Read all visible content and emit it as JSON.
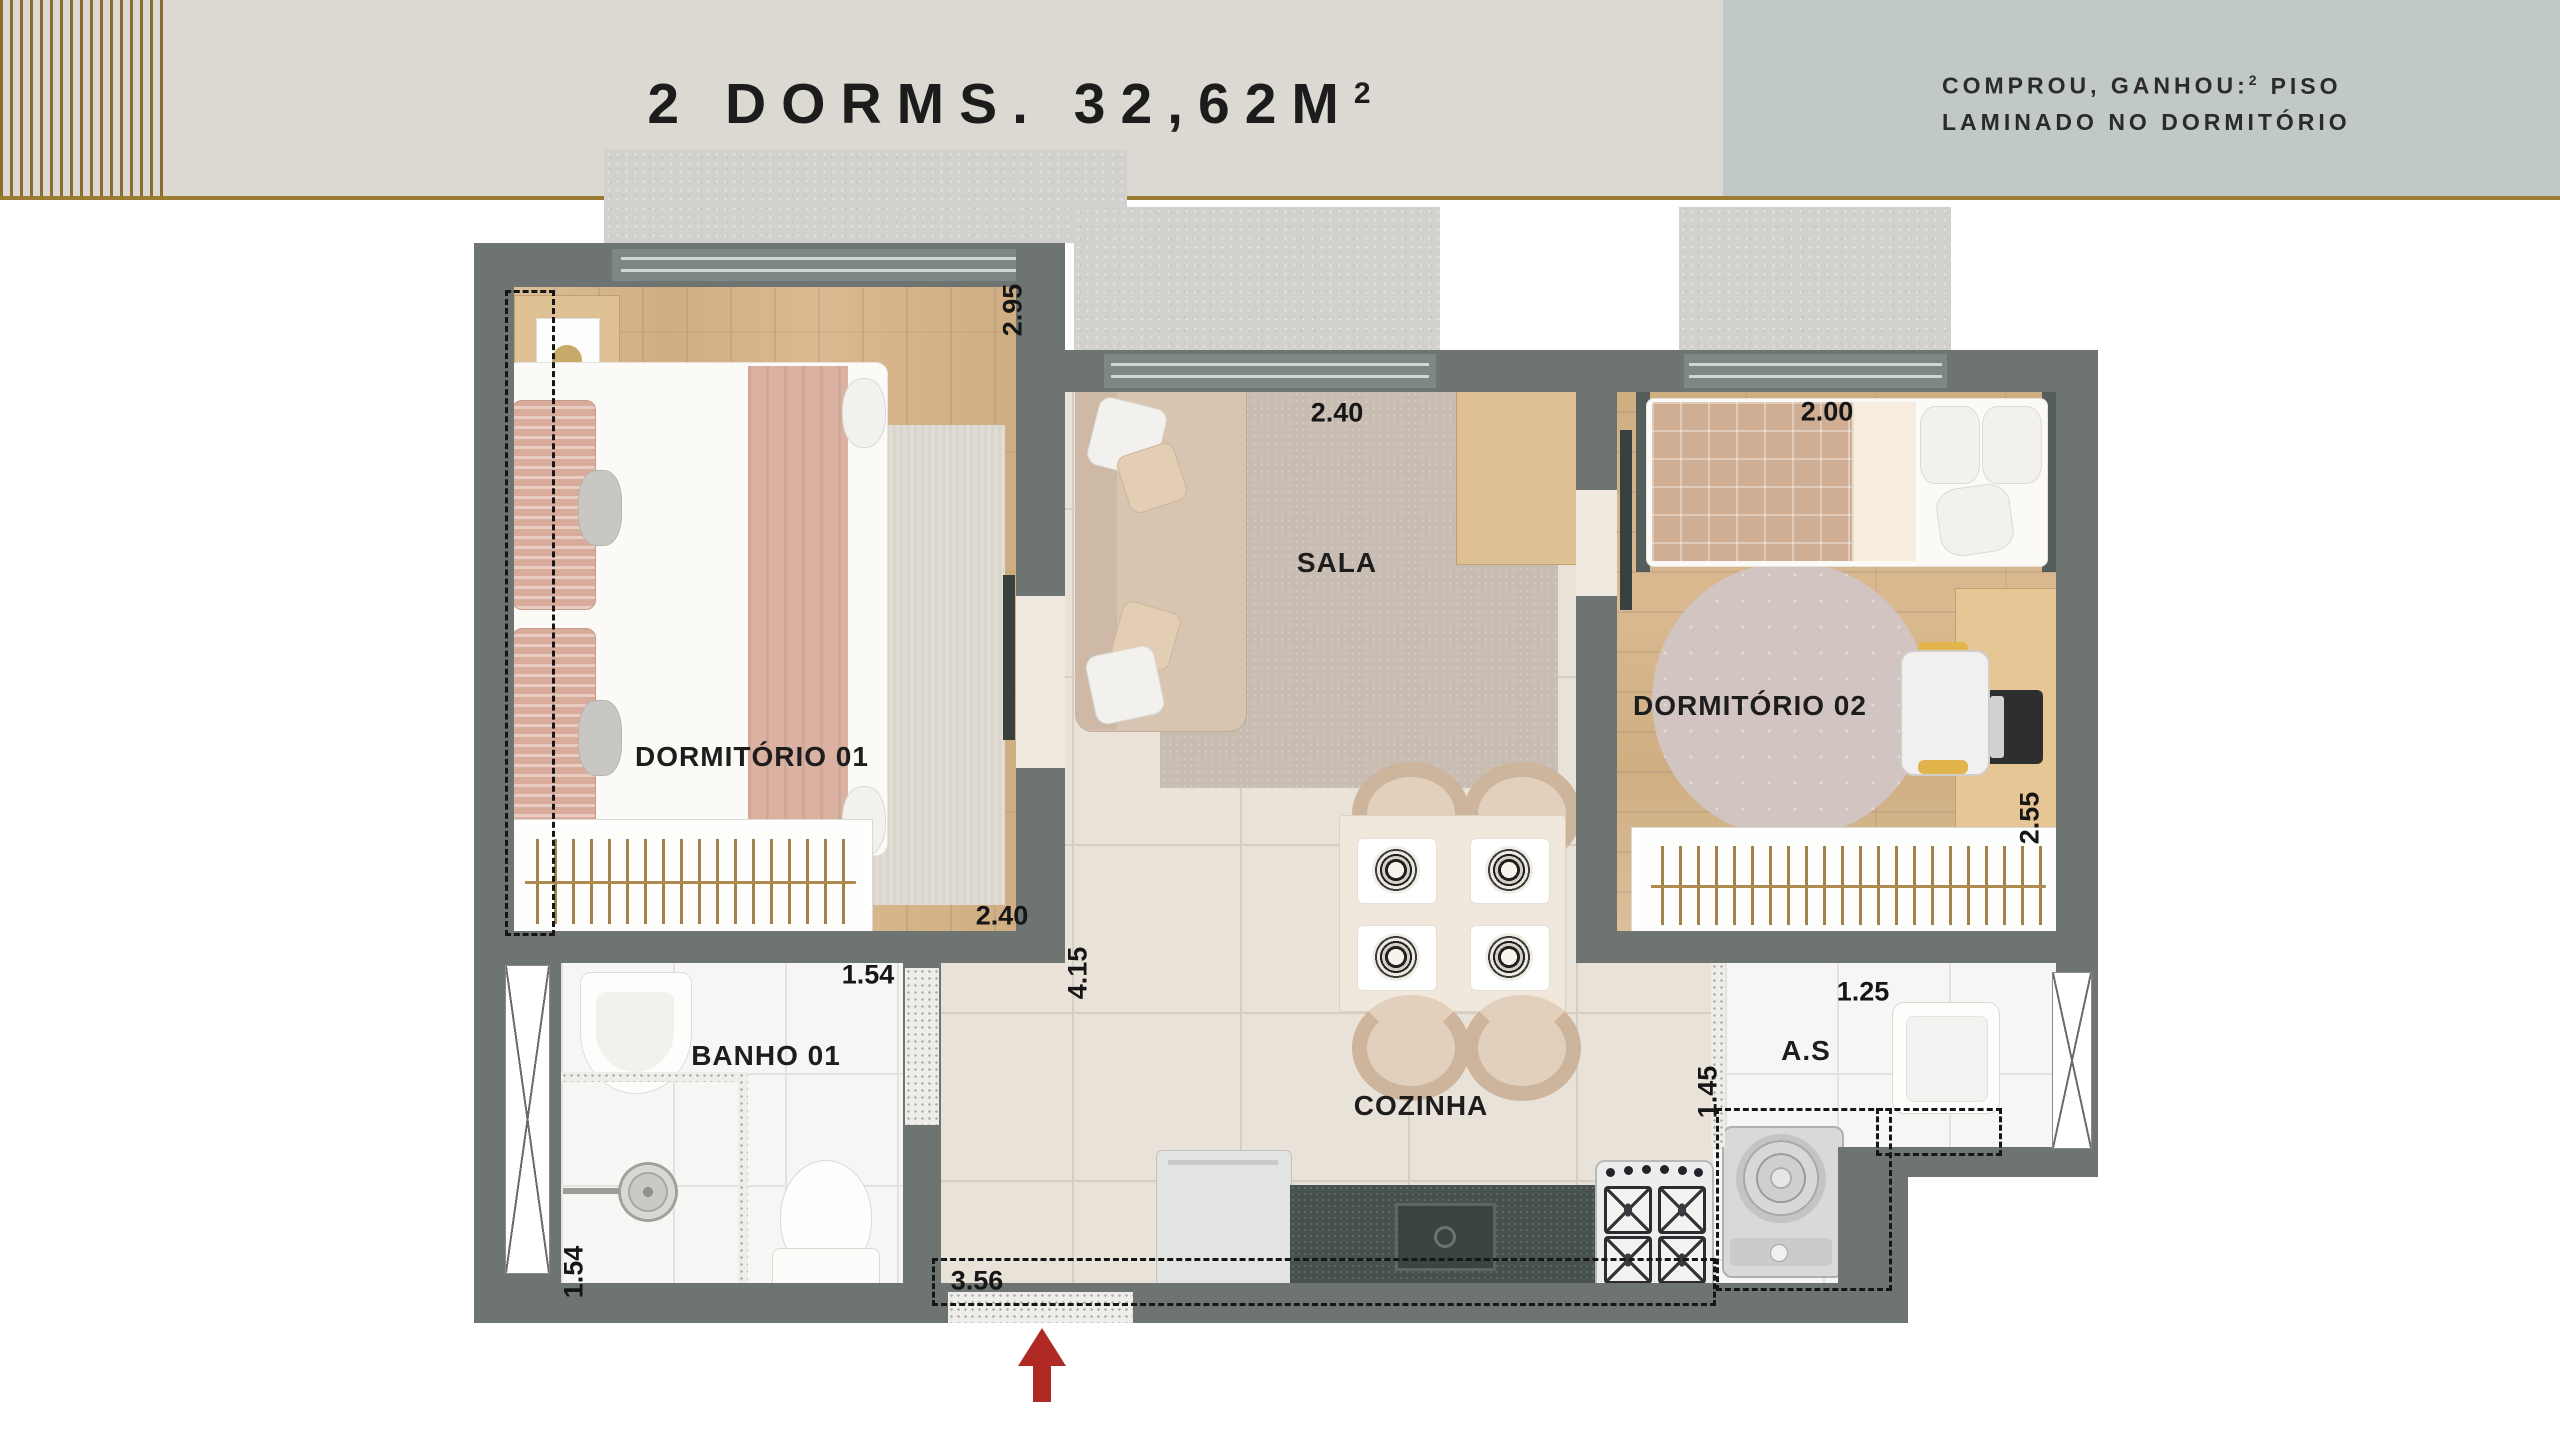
{
  "header": {
    "title_main": "2 DORMS. 32,62M",
    "title_sup": "2",
    "promo": {
      "line1_pre": "COMPROU, GANHOU:",
      "line1_sup": "2",
      "line1_post": "PISO",
      "line2": "LAMINADO NO DORMITÓRIO"
    }
  },
  "plan": {
    "rooms": {
      "dorm1": "DORMITÓRIO 01",
      "sala": "SALA",
      "dorm2": "DORMITÓRIO 02",
      "banho": "BANHO 01",
      "cozinha": "COZINHA",
      "area_servico": "A.S"
    },
    "dimensions": {
      "dorm1_depth": "2.95",
      "dorm1_width": "2.40",
      "sala_width": "2.40",
      "hall_depth": "4.15",
      "dorm2_width": "2.00",
      "dorm2_depth": "2.55",
      "banho_width": "1.54",
      "banho_depth": "1.54",
      "as_width": "1.25",
      "as_depth": "1.45",
      "entry_width": "3.56"
    }
  },
  "colors": {
    "accent_gold": "#9c7b33",
    "wall_gray": "#6d7472",
    "header_left_bg": "#dcd9d3",
    "header_right_bg": "#c0c9c6",
    "arrow_red": "#b02a25"
  }
}
